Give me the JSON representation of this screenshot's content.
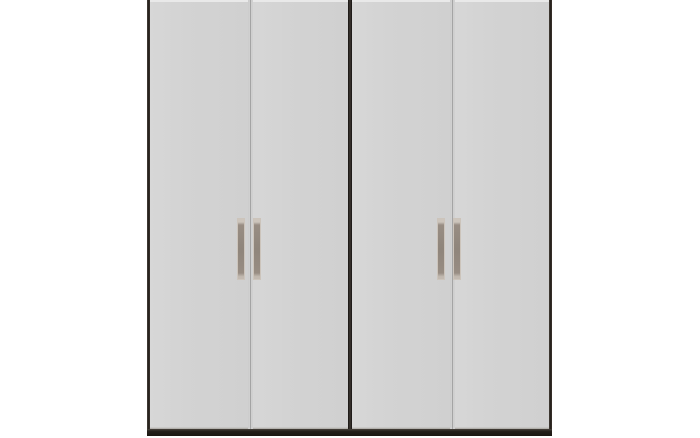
{
  "scene": {
    "description": "Product photo of a four-door double wardrobe on a plain white background, cropped at the top of the frame",
    "background_color": "#ffffff"
  },
  "wardrobe": {
    "kind": "double wardrobe, two side-by-side units, four hinged doors",
    "door_count": 4,
    "handle_count": 4,
    "handle_style": "vertical metal bar handle",
    "units": [
      {
        "name": "left-unit",
        "doors": [
          {
            "name": "door-1",
            "handle": "vertical-bar-handle"
          },
          {
            "name": "door-2",
            "handle": "vertical-bar-handle"
          }
        ]
      },
      {
        "name": "right-unit",
        "doors": [
          {
            "name": "door-3",
            "handle": "vertical-bar-handle"
          },
          {
            "name": "door-4",
            "handle": "vertical-bar-handle"
          }
        ]
      }
    ],
    "colors": {
      "background": "#ffffff",
      "door_face": "#d3d3d3",
      "door_highlight": "#e9e9e9",
      "door_gap_line": "#959595",
      "frame_dark": "#241f1a",
      "base_plinth": "#241f1a",
      "handle_body": "#988d83",
      "handle_trim": "#ccc4bb"
    }
  }
}
